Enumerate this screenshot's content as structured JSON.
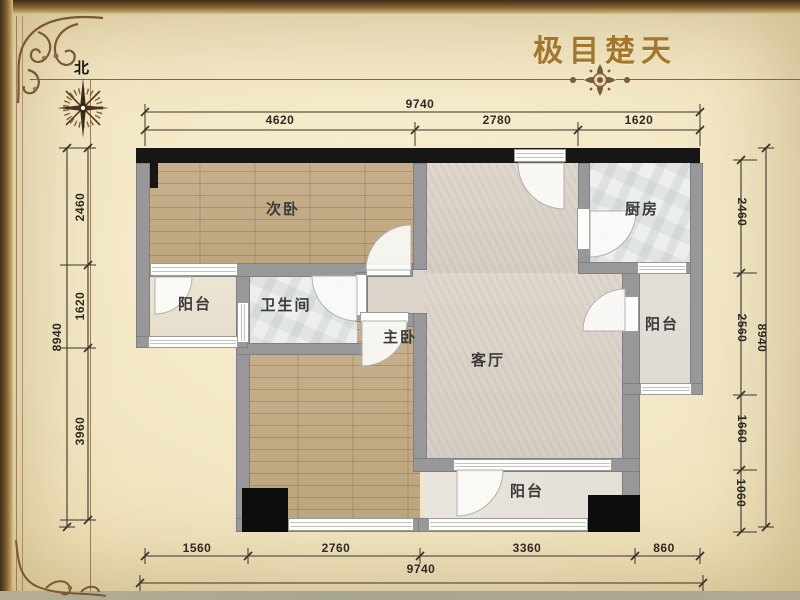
{
  "title": "极目楚天",
  "compass": {
    "north": "北"
  },
  "rooms": {
    "secondary_bedroom": "次卧",
    "kitchen": "厨房",
    "balcony_left": "阳台",
    "bathroom": "卫生间",
    "master_bedroom": "主卧",
    "living_room": "客厅",
    "balcony_right": "阳台",
    "balcony_bottom": "阳台"
  },
  "dimensions": {
    "top": {
      "total": "9740",
      "segments": [
        "4620",
        "2780",
        "1620"
      ]
    },
    "bottom": {
      "total": "9740",
      "segments": [
        "1560",
        "2760",
        "3360",
        "860"
      ]
    },
    "left": {
      "total": "8940",
      "segments": [
        "2460",
        "1620",
        "3960"
      ]
    },
    "right": {
      "total": "8940",
      "segments": [
        "2460",
        "2560",
        "1660",
        "1060"
      ]
    }
  },
  "colors": {
    "background": "#f2e6c4",
    "frame": "#7a5833",
    "title_text": "#a2772c",
    "wall": "#98979a",
    "wall_black": "#161616",
    "wood_floor": "#c8b28f",
    "living_floor": "#dcd4ca",
    "marble_floor": "#edefee",
    "dimension_text": "#2e2923"
  }
}
